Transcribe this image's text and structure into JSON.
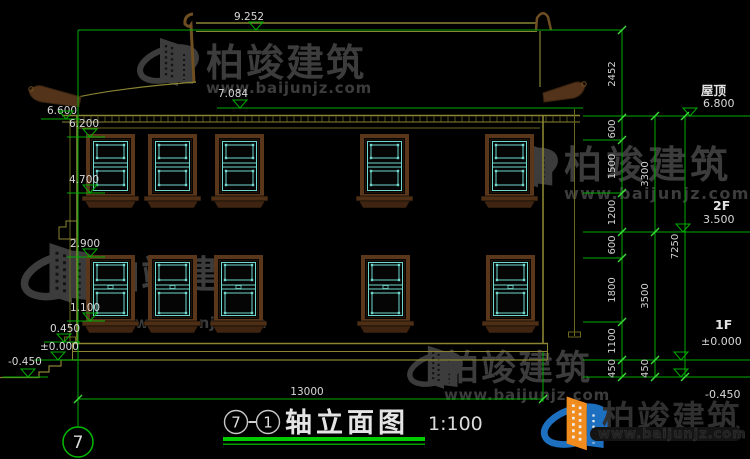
{
  "drawing": {
    "title": {
      "axis_start": "7",
      "axis_end": "1",
      "name": "轴立面图",
      "scale": "1:100"
    },
    "axis_bubble_label": "7",
    "top_levels": [
      {
        "value": "9.252"
      },
      {
        "value": "7.084"
      }
    ],
    "left_levels": [
      {
        "value": "6.600"
      },
      {
        "value": "6.200"
      },
      {
        "value": "4.700"
      },
      {
        "value": "2.900"
      },
      {
        "value": "1.100"
      },
      {
        "value": "0.450"
      },
      {
        "value": "±0.000"
      },
      {
        "value": "-0.450"
      }
    ],
    "right_levels": [
      {
        "label": "屋顶",
        "value": "6.800"
      },
      {
        "label": "2F",
        "value": "3.500"
      },
      {
        "label": "1F",
        "value": "±0.000"
      },
      {
        "label": "",
        "value": "-0.450"
      }
    ],
    "dim_chains": {
      "inner": [
        "2452",
        "600",
        "1500",
        "1200",
        "600",
        "1800",
        "1100",
        "450"
      ],
      "middle": [
        "3300",
        "3500",
        "450"
      ],
      "outer": [
        "7250"
      ]
    },
    "bottom_dim": "13000"
  },
  "watermark": {
    "name": "柏竣建筑",
    "url": "www.baijunjz.com"
  },
  "colors": {
    "line_olive": "#8a8433",
    "line_olive_dark": "#6c671f",
    "line_green": "#00ad00",
    "tick_green": "#3ddc3d",
    "lattice_cyan": "#6fd8cc",
    "frame_brown": "#5a371b",
    "text_white": "#d8d8d8",
    "watermark_gray": "#3c3c3c",
    "logo_blue": "#1d6fc0",
    "logo_orange": "#f08c1e"
  }
}
